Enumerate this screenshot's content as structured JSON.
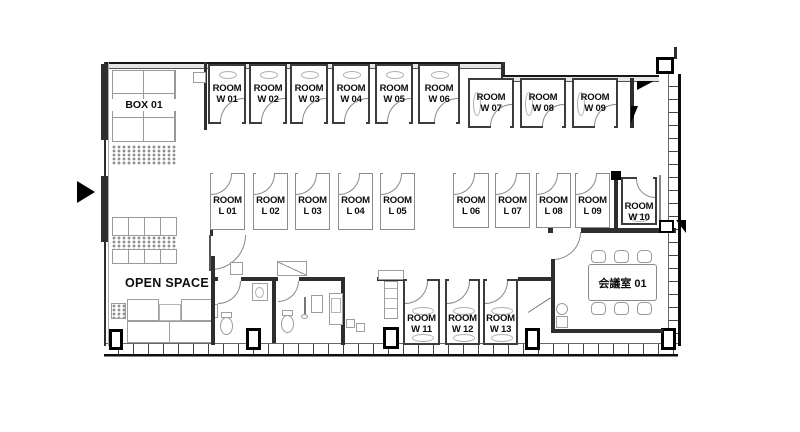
{
  "floorplan": {
    "box": {
      "label": "BOX 01"
    },
    "open_space": {
      "label": "OPEN SPACE"
    },
    "meeting_room": {
      "label": "会議室 01"
    },
    "rooms_w_top": [
      {
        "line1": "ROOM",
        "line2": "W 01"
      },
      {
        "line1": "ROOM",
        "line2": "W 02"
      },
      {
        "line1": "ROOM",
        "line2": "W 03"
      },
      {
        "line1": "ROOM",
        "line2": "W 04"
      },
      {
        "line1": "ROOM",
        "line2": "W 05"
      },
      {
        "line1": "ROOM",
        "line2": "W 06"
      }
    ],
    "rooms_w_upper": [
      {
        "line1": "ROOM",
        "line2": "W 07"
      },
      {
        "line1": "ROOM",
        "line2": "W 08"
      },
      {
        "line1": "ROOM",
        "line2": "W 09"
      }
    ],
    "rooms_l_left": [
      {
        "line1": "ROOM",
        "line2": "L 01"
      },
      {
        "line1": "ROOM",
        "line2": "L 02"
      },
      {
        "line1": "ROOM",
        "line2": "L 03"
      },
      {
        "line1": "ROOM",
        "line2": "L 04"
      },
      {
        "line1": "ROOM",
        "line2": "L 05"
      }
    ],
    "rooms_l_right": [
      {
        "line1": "ROOM",
        "line2": "L 06"
      },
      {
        "line1": "ROOM",
        "line2": "L 07"
      },
      {
        "line1": "ROOM",
        "line2": "L 08"
      },
      {
        "line1": "ROOM",
        "line2": "L 09"
      }
    ],
    "room_w10": [
      {
        "line1": "ROOM",
        "line2": "W 10"
      }
    ],
    "rooms_w_lower": [
      {
        "line1": "ROOM",
        "line2": "W 11"
      },
      {
        "line1": "ROOM",
        "line2": "W 12"
      },
      {
        "line1": "ROOM",
        "line2": "W 13"
      }
    ]
  }
}
